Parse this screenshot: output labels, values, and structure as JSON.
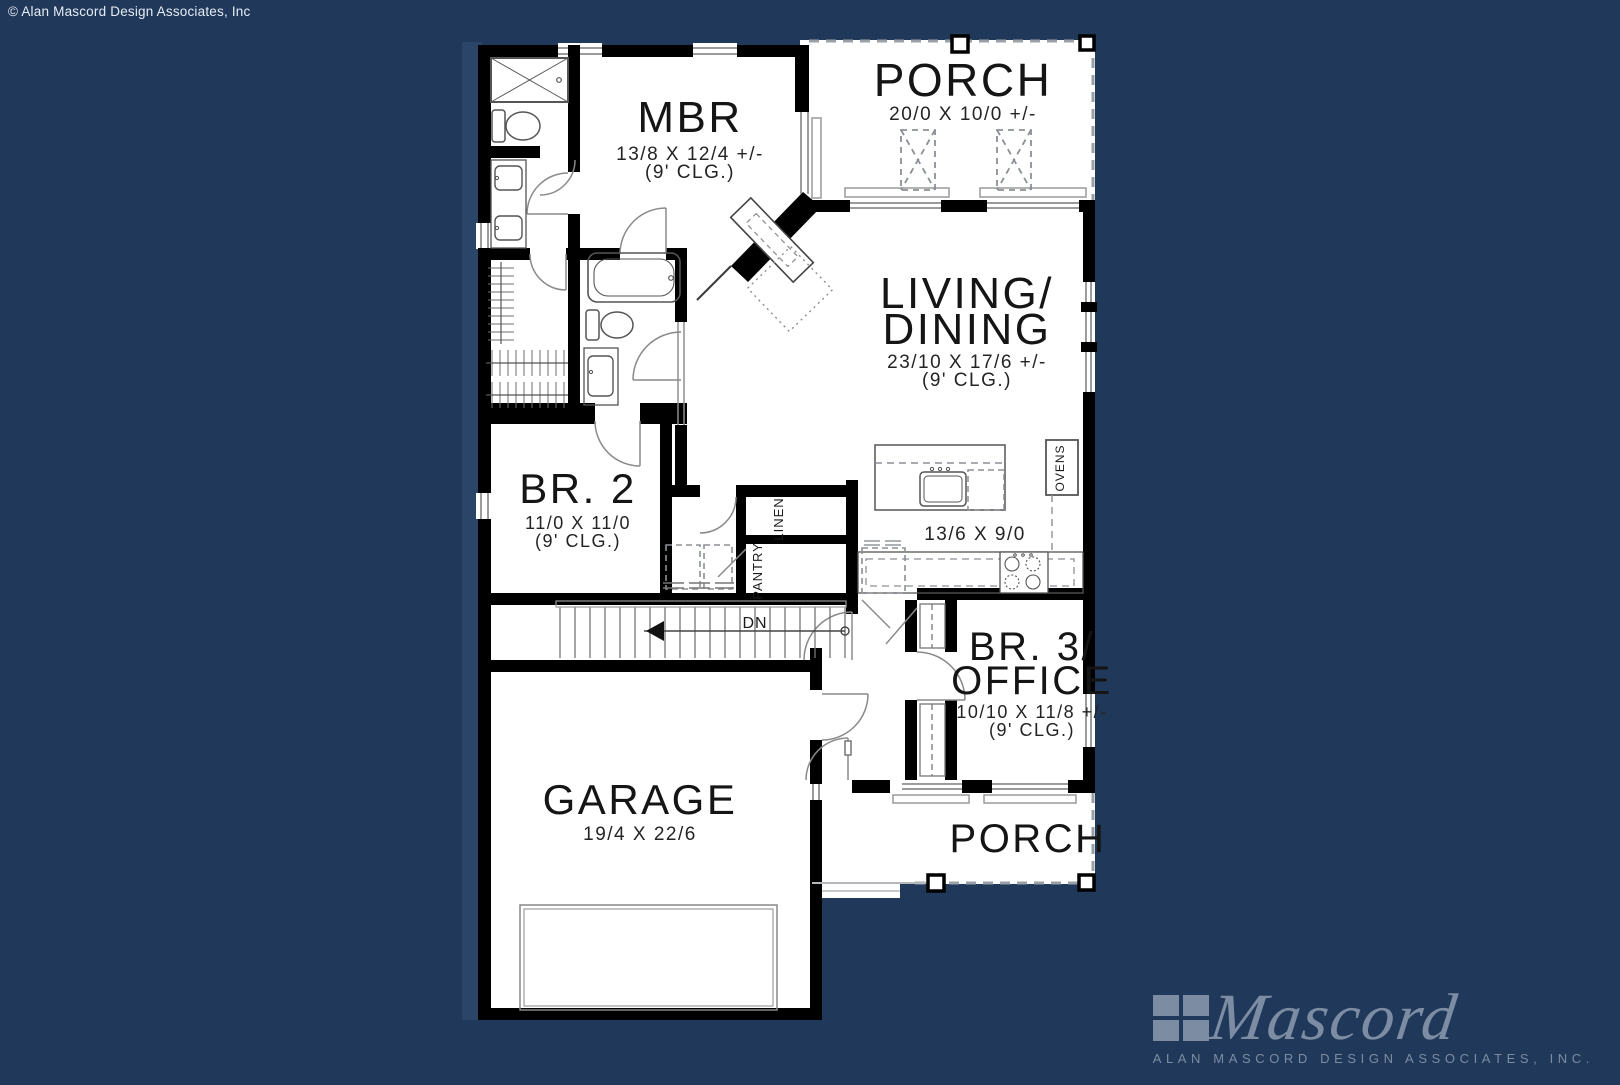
{
  "page": {
    "background_color": "#20385A",
    "paper_color": "#FFFFFF",
    "copyright": "© Alan Mascord Design Associates, Inc"
  },
  "rooms": {
    "mbr": {
      "name": "MBR",
      "dims": "13/8 X 12/4 +/-",
      "ceiling": "(9' CLG.)"
    },
    "porch_top": {
      "name": "PORCH",
      "dims": "20/0 X 10/0 +/-"
    },
    "living_dining": {
      "name_line1": "LIVING/",
      "name_line2": "DINING",
      "dims": "23/10 X 17/6 +/-",
      "ceiling": "(9' CLG.)"
    },
    "br2": {
      "name": "BR. 2",
      "dims": "11/0 X 11/0",
      "ceiling": "(9' CLG.)"
    },
    "kitchen": {
      "dims": "13/6 X 9/0"
    },
    "br3_office": {
      "name_line1": "BR. 3/",
      "name_line2": "OFFICE",
      "dims": "10/10 X 11/8 +/-",
      "ceiling": "(9' CLG.)"
    },
    "garage": {
      "name": "GARAGE",
      "dims": "19/4 X 22/6"
    },
    "porch_bottom": {
      "name": "PORCH"
    }
  },
  "labels": {
    "pantry": "PANTRY",
    "linen": "LINEN",
    "ovens": "OVENS",
    "stairs_down": "DN"
  },
  "logo": {
    "script": "Mascord",
    "subtext": "ALAN MASCORD DESIGN ASSOCIATES, INC.",
    "color": "#7C8DA3"
  }
}
